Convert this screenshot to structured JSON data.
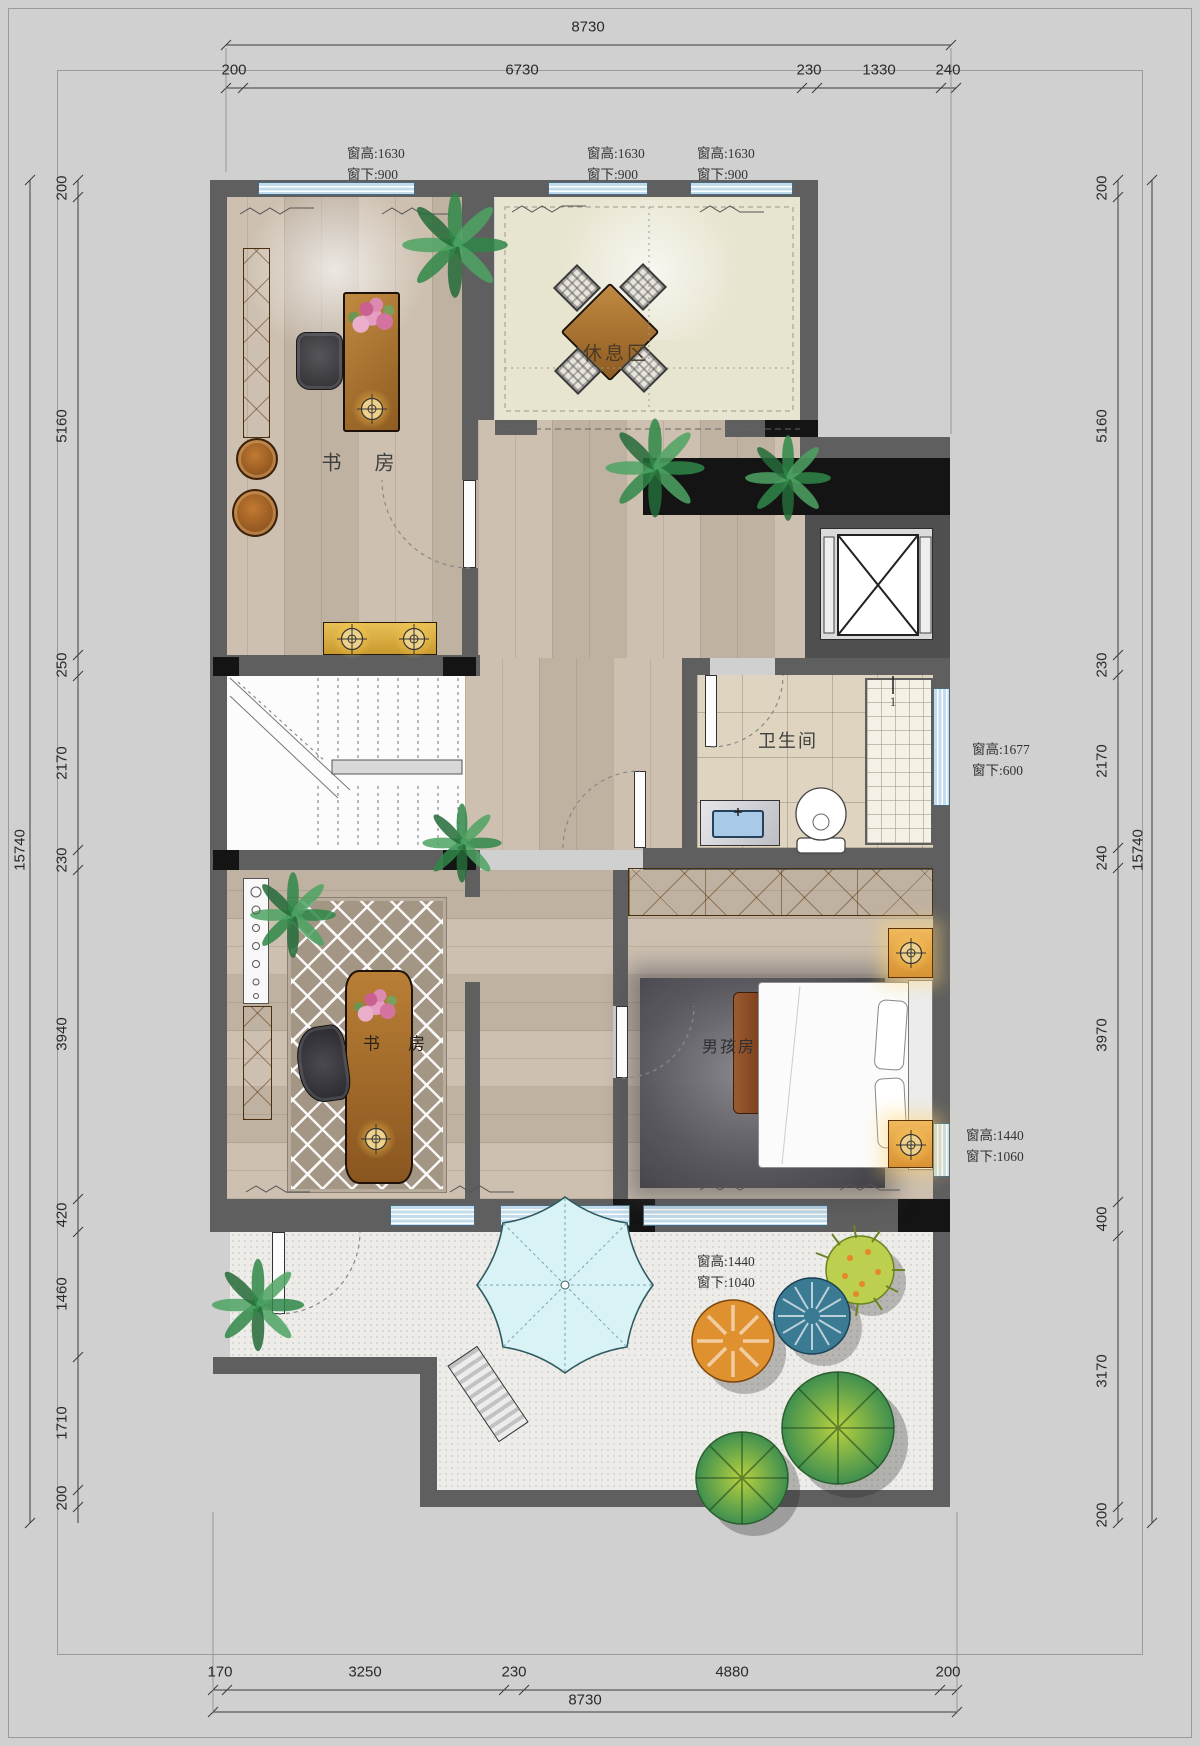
{
  "page": {
    "type": "residential floor plan",
    "background": "#d0d0d0"
  },
  "dimensions": {
    "top": {
      "total": "8730",
      "segments": [
        "200",
        "6730",
        "230",
        "1330",
        "240"
      ]
    },
    "bottom": {
      "total": "8730",
      "segments": [
        "170",
        "3250",
        "230",
        "4880",
        "200"
      ]
    },
    "left": {
      "total": "15740",
      "segments": [
        "200",
        "5160",
        "250",
        "2170",
        "230",
        "3940",
        "420",
        "1460",
        "1710",
        "200"
      ]
    },
    "right": {
      "total": "15740",
      "segments": [
        "200",
        "5160",
        "230",
        "2170",
        "240",
        "3970",
        "400",
        "3170",
        "200"
      ]
    }
  },
  "window_notes": [
    {
      "height": "窗高:1630",
      "sill": "窗下:900"
    },
    {
      "height": "窗高:1630",
      "sill": "窗下:900"
    },
    {
      "height": "窗高:1630",
      "sill": "窗下:900"
    },
    {
      "height": "窗高:1677",
      "sill": "窗下:600"
    },
    {
      "height": "窗高:1440",
      "sill": "窗下:1060"
    },
    {
      "height": "窗高:1440",
      "sill": "窗下:1040"
    }
  ],
  "rooms": {
    "study_upper": "书 房",
    "lounge": "休息区",
    "bathroom": "卫生间",
    "study_lower": "书 房",
    "boys_room": "男孩房"
  },
  "markers": {
    "shower_door": "1"
  },
  "colors": {
    "wall": "#5f5f5f",
    "window": "#c2dcec",
    "wood_floor": "#c9bbaa",
    "lounge_floor": "#e7e4cf",
    "bath_tile": "#ded4bf",
    "terrace_floor": "#edece8",
    "wardrobe_wood": "#e6ad62",
    "desk_wood": "#a8752f",
    "dark_rug": "#4b4b50",
    "umbrella": "#d9f2f5",
    "rug_lattice": "#a49685"
  }
}
